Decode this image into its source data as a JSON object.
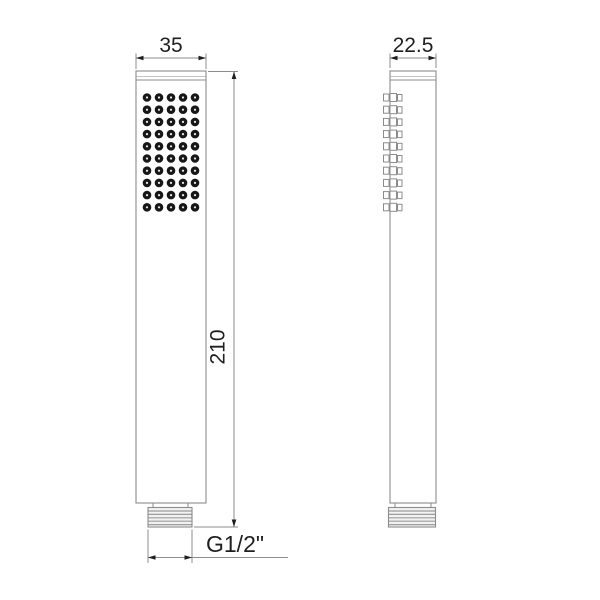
{
  "views": {
    "front": {
      "width_dimension": "35",
      "height_dimension": "210",
      "thread_dimension": "G1/2\"",
      "nozzle_grid": {
        "columns": 5,
        "rows": 10
      }
    },
    "side": {
      "width_dimension": "22.5",
      "nozzle_rows": 10
    }
  },
  "colors": {
    "outline": "#8c8c8c",
    "cap_line_light": "#c4c4c4",
    "dimension_line": "#8c8c8c",
    "arrow_and_text": "#1f1f1f",
    "nozzle_dot": "#171717",
    "nozzle_dot_center": "#ededed",
    "thread_line": "#9c9c9c",
    "thread_fill": "#f2f2f2",
    "background": "#ffffff"
  }
}
